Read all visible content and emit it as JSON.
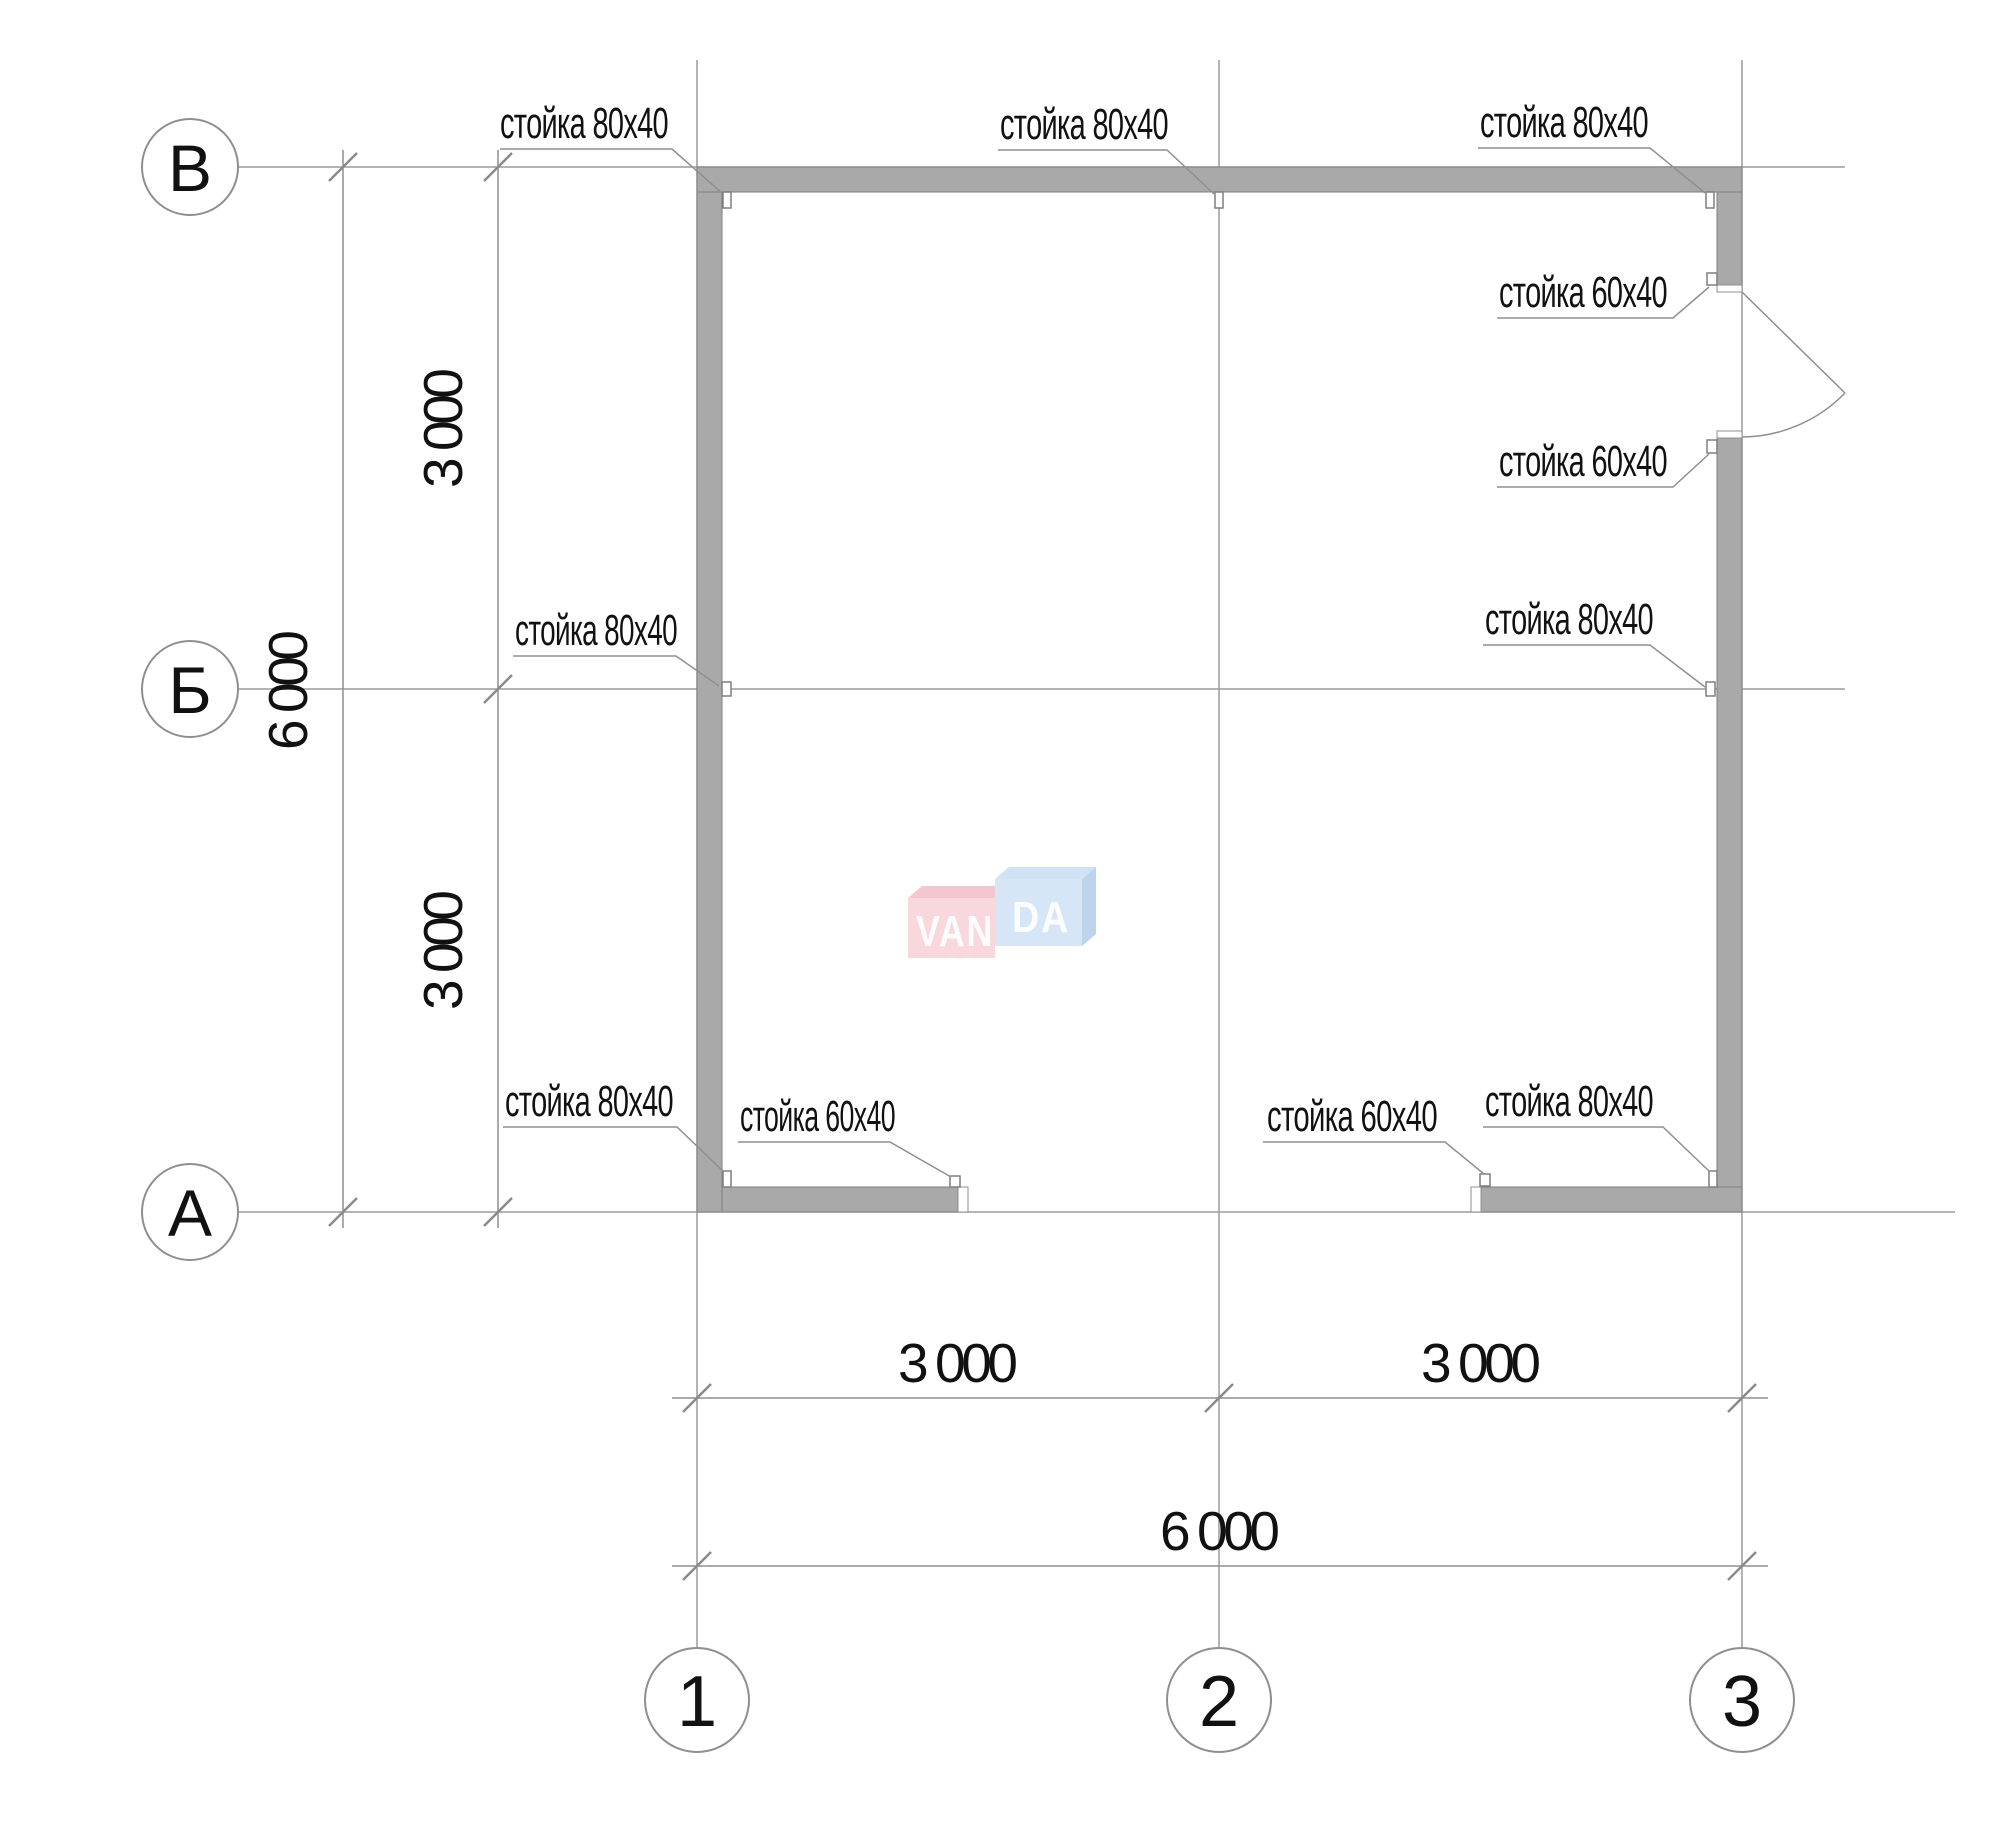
{
  "drawing": {
    "type": "floor-plan",
    "watermark": {
      "left": "VAN",
      "right": "DA"
    },
    "grid_rows": [
      {
        "label": "В"
      },
      {
        "label": "Б"
      },
      {
        "label": "А"
      }
    ],
    "grid_cols": [
      {
        "label": "1"
      },
      {
        "label": "2"
      },
      {
        "label": "3"
      }
    ],
    "dimensions": {
      "left_top_segment": "3 000",
      "left_bottom_segment": "3 000",
      "left_overall": "6 000",
      "bottom_left_segment": "3 000",
      "bottom_right_segment": "3 000",
      "bottom_overall": "6 000"
    },
    "leader_labels": [
      {
        "id": "top-left",
        "text": "стойка 80х40"
      },
      {
        "id": "top-middle",
        "text": "стойка 80х40"
      },
      {
        "id": "top-right",
        "text": "стойка 80х40"
      },
      {
        "id": "door-upper",
        "text": "стойка 60х40"
      },
      {
        "id": "door-lower",
        "text": "стойка 60х40"
      },
      {
        "id": "mid-right",
        "text": "стойка 80х40"
      },
      {
        "id": "mid-left",
        "text": "стойка 80х40"
      },
      {
        "id": "bottom-left-80",
        "text": "стойка 80х40"
      },
      {
        "id": "bottom-left-60",
        "text": "стойка 60х40"
      },
      {
        "id": "bottom-right-60",
        "text": "стойка 60х40"
      },
      {
        "id": "bottom-right-80",
        "text": "стойка 80х40"
      }
    ],
    "colors": {
      "wall_fill": "#a9a9a9",
      "wall_stroke": "#7f7f7f",
      "thin_line": "#8f8f8f",
      "text": "#111111",
      "logo_pink_front": "#f8d7dd",
      "logo_pink_top": "#f2c7cf",
      "logo_blue_front": "#d7e6f6",
      "logo_blue_top": "#cfe3f5",
      "logo_blue_side": "#bcd4ec"
    }
  }
}
